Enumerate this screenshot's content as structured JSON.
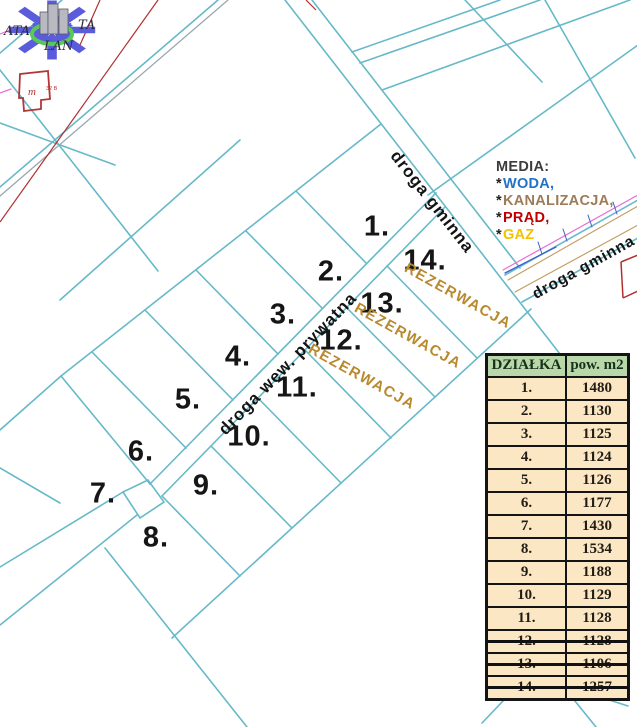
{
  "map": {
    "road_labels": {
      "gminna_top": "droga gminna",
      "gminna_right": "droga gminna",
      "private": "droga wew. prywatna"
    },
    "reservation_label": "REZERWACJA",
    "plots": [
      {
        "label": "1."
      },
      {
        "label": "2."
      },
      {
        "label": "3."
      },
      {
        "label": "4."
      },
      {
        "label": "5."
      },
      {
        "label": "6."
      },
      {
        "label": "7."
      },
      {
        "label": "8."
      },
      {
        "label": "9."
      },
      {
        "label": "10."
      },
      {
        "label": "11."
      },
      {
        "label": "12."
      },
      {
        "label": "13."
      },
      {
        "label": "14."
      }
    ],
    "building_label": "m",
    "building_note": "32 B",
    "logo": {
      "left": "ATA",
      "right": "TA",
      "bottom": "LAN"
    }
  },
  "media": {
    "title": "MEDIA:",
    "items": [
      {
        "bullet": "*",
        "label": "WODA,",
        "color": "#2273c6"
      },
      {
        "bullet": "*",
        "label": "KANALIZACJA,",
        "color": "#9e7b57"
      },
      {
        "bullet": "*",
        "label": "PRĄD,",
        "color": "#c00000"
      },
      {
        "bullet": "*",
        "label": "GAZ",
        "color": "#f2c200"
      }
    ]
  },
  "table": {
    "headers": [
      "DZIAŁKA",
      "pow. m2"
    ],
    "rows": [
      {
        "num": "1.",
        "area": "1480",
        "struck": false
      },
      {
        "num": "2.",
        "area": "1130",
        "struck": false
      },
      {
        "num": "3.",
        "area": "1125",
        "struck": false
      },
      {
        "num": "4.",
        "area": "1124",
        "struck": false
      },
      {
        "num": "5.",
        "area": "1126",
        "struck": false
      },
      {
        "num": "6.",
        "area": "1177",
        "struck": false
      },
      {
        "num": "7.",
        "area": "1430",
        "struck": false
      },
      {
        "num": "8.",
        "area": "1534",
        "struck": false
      },
      {
        "num": "9.",
        "area": "1188",
        "struck": false
      },
      {
        "num": "10.",
        "area": "1129",
        "struck": false
      },
      {
        "num": "11.",
        "area": "1128",
        "struck": false
      },
      {
        "num": "12.",
        "area": "1128",
        "struck": true
      },
      {
        "num": "13.",
        "area": "1106",
        "struck": true
      },
      {
        "num": "14.",
        "area": "1257",
        "struck": true
      }
    ]
  },
  "colors": {
    "parcel_line": "#66b9c9",
    "reservation_text": "#b9892e",
    "table_header_bg": "#b9d8a9",
    "table_cell_bg": "#fbe7c3",
    "red_boundary": "#b03030",
    "utility_pink": "#ea6fd0",
    "utility_tan": "#c29a5d",
    "utility_blue": "#3f5fd0"
  }
}
